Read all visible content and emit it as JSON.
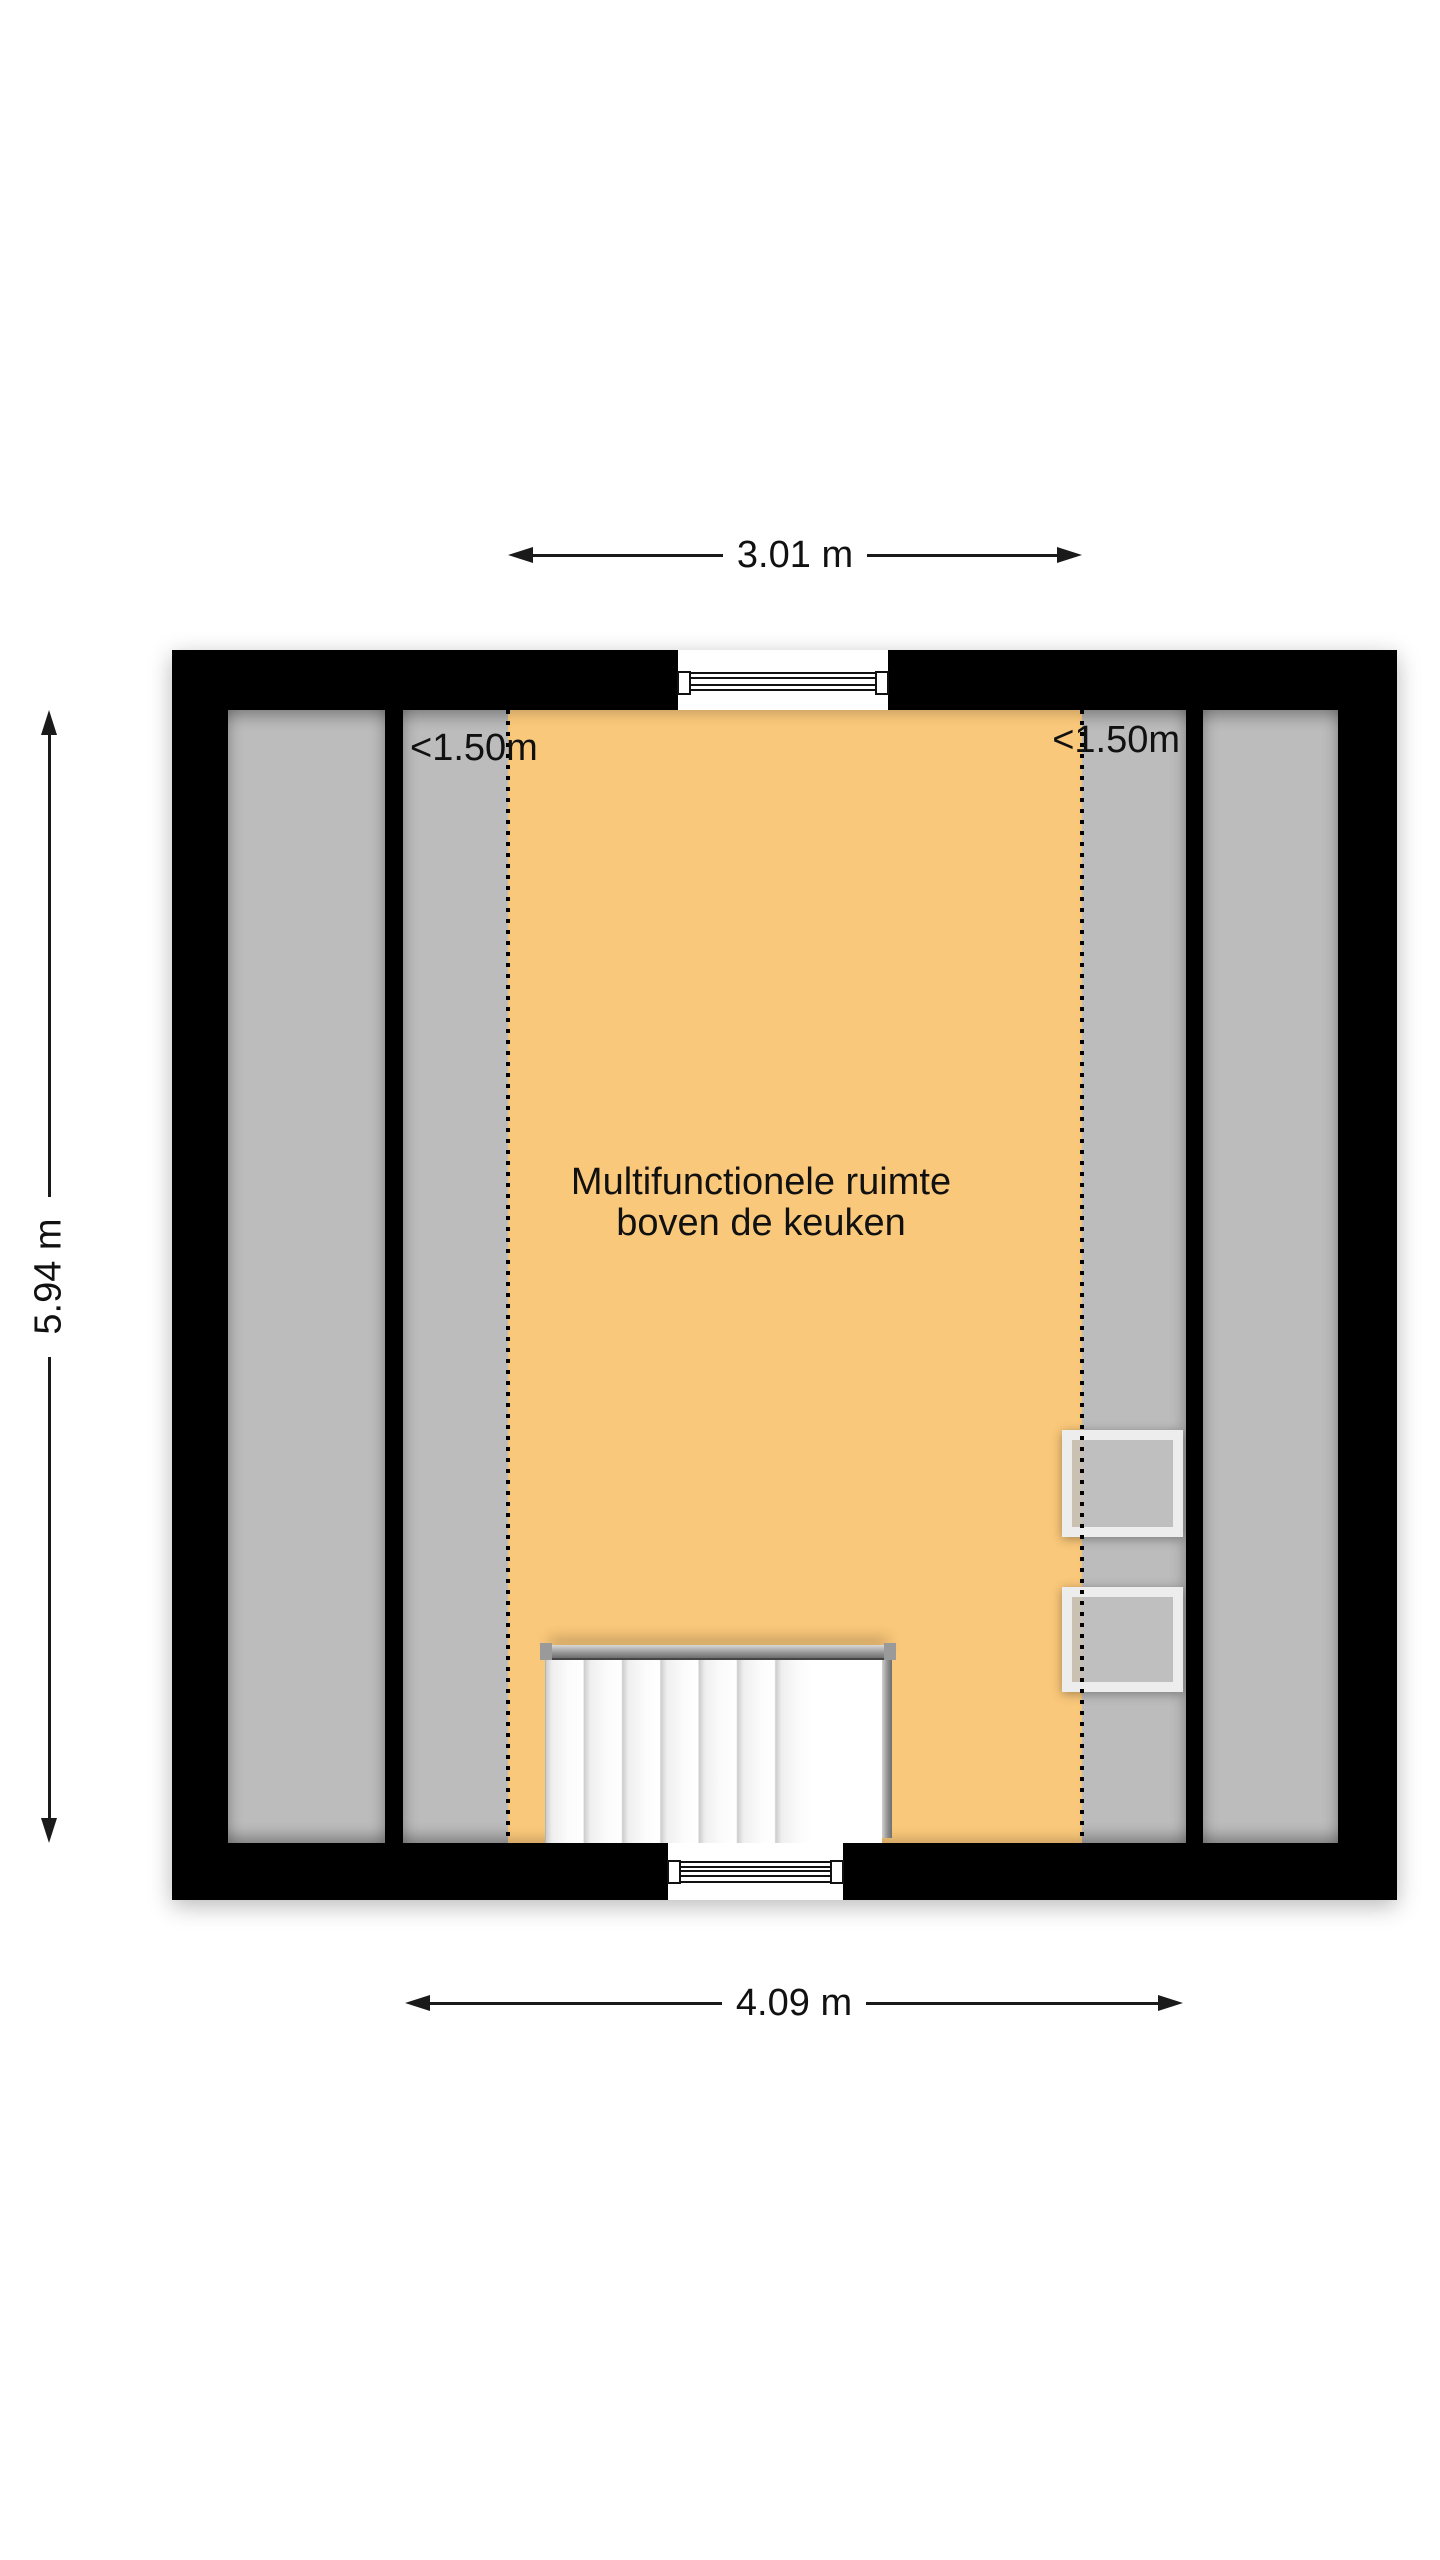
{
  "floor_plan": {
    "title": "Multifunctionele ruimte boven de keuken",
    "room_label": {
      "line1": "Multifunctionele ruimte",
      "line2": "boven de keuken"
    },
    "dimensions": {
      "top": "3.01 m",
      "left": "5.94 m",
      "bottom": "4.09 m"
    },
    "headroom_labels": {
      "left": "<1.50m",
      "right": "<1.50m"
    },
    "features": {
      "staircase": "open staircase at bottom center",
      "roof_windows": 2,
      "windows": [
        "top wall window",
        "bottom wall window"
      ]
    },
    "colors": {
      "wall": "#000000",
      "floor_gray": "#bcbcbc",
      "zone_orange": "#fac87a",
      "stair_white": "#ffffff",
      "roof_window_frame": "#ededed",
      "background": "#ffffff",
      "line": "#1a1a1a"
    }
  }
}
